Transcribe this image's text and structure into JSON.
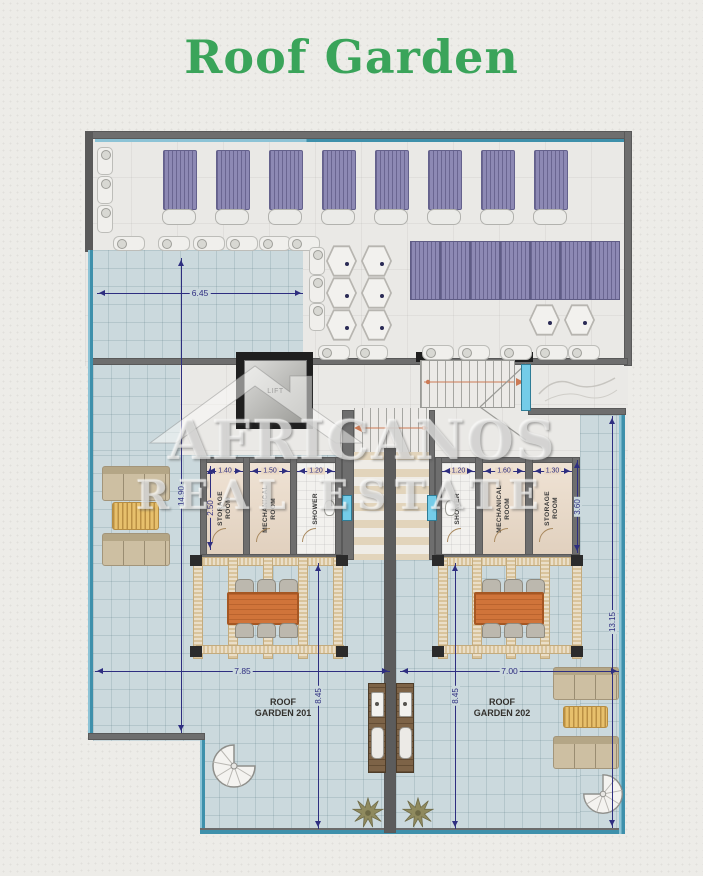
{
  "title": "Roof Garden",
  "watermark": {
    "brand": "AFRICANOS",
    "tagline": "REAL ESTATE"
  },
  "labels": {
    "lift": "LIFT",
    "garden201": "ROOF\nGARDEN 201",
    "garden202": "ROOF\nGARDEN 202"
  },
  "rooms_left": [
    {
      "name": "STORAGE\nROOM",
      "width_dim": "1.40"
    },
    {
      "name": "MECHANICAL\nROOM",
      "width_dim": "1.50"
    },
    {
      "name": "SHOWER",
      "width_dim": "1.20"
    }
  ],
  "rooms_right": [
    {
      "name": "SHOWER",
      "width_dim": "1.20"
    },
    {
      "name": "MECHANICAL\nROOM",
      "width_dim": "1.60"
    },
    {
      "name": "STORAGE\nROOM",
      "width_dim": "1.30"
    }
  ],
  "dimensions": {
    "terrace_width": "6.45",
    "left_depth": "14.90",
    "storage_left_depth": "2.50",
    "storage_right_depth": "3.60",
    "garden201_width": "7.85",
    "garden201_depth": "8.45",
    "garden202_width": "7.00",
    "garden202_depth": "8.45",
    "right_depth": "13.15"
  },
  "colors": {
    "title_green": "#3aa45a",
    "dimension_blue": "#2e2e80",
    "floor_tile": "#cbd9dd",
    "room_floor": "#ead9c6",
    "lounger_purple": "#8d89b4",
    "wall_gray": "#6e6e6e",
    "glass_teal": "#3e90ab",
    "window_blue": "#74cce8",
    "pergola_wood": "#d9c49c",
    "dining_table_orange": "#d0743a",
    "sofa_tan": "#cdbfa2",
    "bbq_brown": "#7d6347"
  }
}
